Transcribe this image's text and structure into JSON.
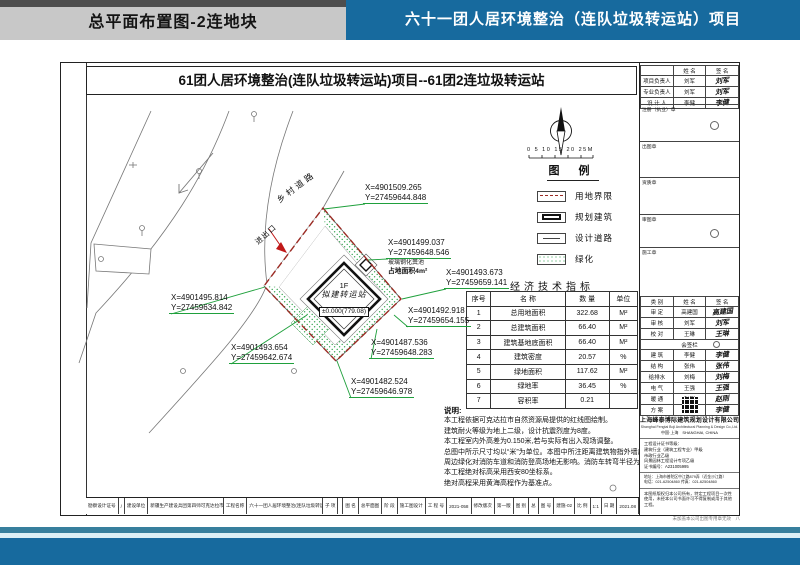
{
  "header": {
    "left_title": "总平面布置图-2连地块",
    "right_title": "六十一团人居环境整治（连队垃圾转运站）项目"
  },
  "colors": {
    "accent_blue": "#176a9e",
    "header_gray": "#c8c8c8",
    "strip_dark": "#4e4e4e",
    "leader_green": "#1fa03c",
    "greenery_green": "#2ca04a",
    "boundary_red": "#9b2b24",
    "teal_strip": "#377f9d",
    "pale_strip": "#ddf0f6"
  },
  "sheet": {
    "title": "61团人居环境整治(连队垃圾转运站)项目--61团2连垃圾转运站",
    "scale_label": "0  5  10  15  20  25M",
    "legend": {
      "title": "图 例",
      "items": [
        {
          "label": "用地界限",
          "swatch": "boundary"
        },
        {
          "label": "规划建筑",
          "swatch": "building"
        },
        {
          "label": "设计道路",
          "swatch": "road"
        },
        {
          "label": "绿化",
          "swatch": "green"
        }
      ]
    },
    "plan": {
      "road_label": "乡村道路",
      "entrance_label": "进出口",
      "building": {
        "floor": "1F",
        "name": "拟建转运站",
        "elevation": "±0.000(779.08)"
      },
      "septic": {
        "line1": "玻璃钢化粪池",
        "line2": "占地面积4m²"
      },
      "coord_labels": [
        {
          "x": 302,
          "y": 120,
          "l1": "X=4901509.265",
          "l2": "Y=27459644.848",
          "px": 263,
          "py": 146
        },
        {
          "x": 325,
          "y": 175,
          "l1": "X=4901499.037",
          "l2": "Y=27459648.546",
          "px": 307,
          "py": 197
        },
        {
          "x": 383,
          "y": 205,
          "l1": "X=4901493.673",
          "l2": "Y=27459659.141",
          "px": 341,
          "py": 236
        },
        {
          "x": 345,
          "y": 243,
          "l1": "X=4901492.918",
          "l2": "Y=27459654.155",
          "px": 333,
          "py": 252
        },
        {
          "x": 308,
          "y": 275,
          "l1": "X=4901487.536",
          "l2": "Y=27459648.283",
          "px": 316,
          "py": 266
        },
        {
          "x": 288,
          "y": 314,
          "l1": "X=4901482.524",
          "l2": "Y=27459646.978",
          "px": 276,
          "py": 298
        },
        {
          "x": 168,
          "y": 280,
          "l1": "X=4901493.654",
          "l2": "Y=27459642.674",
          "px": 246,
          "py": 252
        },
        {
          "x": 108,
          "y": 230,
          "l1": "X=4901495.814",
          "l2": "Y=27459634.842",
          "px": 204,
          "py": 224
        }
      ]
    },
    "table": {
      "title": "经济技术指标",
      "headers": [
        "序号",
        "名  称",
        "数  量",
        "单位"
      ],
      "rows": [
        [
          "1",
          "总用地面积",
          "322.68",
          "M²"
        ],
        [
          "2",
          "总建筑面积",
          "66.40",
          "M²"
        ],
        [
          "3",
          "建筑基地底面积",
          "66.40",
          "M²"
        ],
        [
          "4",
          "建筑密度",
          "20.57",
          "%"
        ],
        [
          "5",
          "绿地面积",
          "117.62",
          "M²"
        ],
        [
          "6",
          "绿地率",
          "36.45",
          "%"
        ],
        [
          "7",
          "容积率",
          "0.21",
          ""
        ]
      ]
    },
    "notes": {
      "title": "说明:",
      "lines": [
        "本工程依据可克达拉市自然资源局提供的红线图绘制。",
        "建筑耐火等级为地上二级，设计抗震烈度为8度。",
        "本工程室内外高差为0.150米,若与实际有出入现场调整。",
        "总图中所示尺寸均以“米”为单位。本图中所注距离建筑物指外墙皮。",
        "周边绿化对消防车道和消防登高场地无影响。消防车转弯半径为9米。",
        "本工程绝对标高采用西安80坐标系。",
        "绝对高程采用黄海高程作为基准点。"
      ]
    }
  },
  "titleblock": {
    "personnel_headers": [
      "",
      "姓 名",
      "签 名"
    ],
    "personnel": [
      [
        "项目负责人",
        "刘军",
        "刘军"
      ],
      [
        "专业负责人",
        "刘军",
        "刘军"
      ],
      [
        "设 计 人",
        "李健",
        "李健"
      ]
    ],
    "stamps": [
      {
        "label": "注册（执业）章",
        "seal": true
      },
      {
        "label": "出图章",
        "seal": false
      },
      {
        "label": "资质章",
        "seal": false
      },
      {
        "label": "审图章",
        "seal": true
      },
      {
        "label": "施工章",
        "seal": false
      }
    ],
    "sign_headers": [
      "类 别",
      "姓 名",
      "签 名"
    ],
    "cosign_label": "会签栏",
    "sign_rows_top": [
      [
        "审 定",
        "高建国",
        "高建国"
      ],
      [
        "审 核",
        "刘军",
        "刘军"
      ],
      [
        "校 对",
        "王琳",
        "王琳"
      ]
    ],
    "sign_rows_bottom": [
      [
        "建 筑",
        "李健",
        "李健"
      ],
      [
        "结 构",
        "张伟",
        "张伟"
      ],
      [
        "给排水",
        "刘梅",
        "刘梅"
      ],
      [
        "电 气",
        "王强",
        "王强"
      ],
      [
        "暖 通",
        "赵刚",
        "赵刚"
      ],
      [
        "方 案",
        "李健",
        "李健"
      ]
    ],
    "company": {
      "name": "上海峰泰博际建筑规划设计有限公司",
      "eng": "Shanghai Fengtai Boji Architectural Planning & Design Co.,Ltd.",
      "loc": "中国·上海　SHANGHAI, CHINA",
      "cert_lines": [
        "工程设计证书等级：",
        "建筑行业（建筑工程专业）甲级",
        "市政行业乙级",
        "风景园林工程设计专项乙级",
        "证书编号：A231005995"
      ],
      "contact_lines": [
        "地址：上海市普陀区中江路879弄（近金沙江路）",
        "电话：021-62504860  传真：021-62504860"
      ],
      "disclaimer": "本图纸版权归本公司所有，特定工程项目一次性使用，未经本公司书面许可不得复制或用于其他工程。"
    }
  },
  "bottombar": {
    "cells": [
      {
        "k": "勘察设计证号",
        "v": "/",
        "grow": false
      },
      {
        "k": "建设单位",
        "v": "新疆生产建设兵团第四师可克达拉市六十一团",
        "grow": true
      },
      {
        "k": "工程名称",
        "v": "六十一团人居环境整治(连队垃圾转运站)项目",
        "grow": true
      },
      {
        "k": "子 项",
        "v": "",
        "grow": false
      },
      {
        "k": "图 名",
        "v": "总平面图",
        "grow": false
      },
      {
        "k": "阶 段",
        "v": "施工图设计",
        "grow": false
      },
      {
        "k": "工 程 号",
        "v": "2021-058",
        "grow": false
      },
      {
        "k": "修改版次",
        "v": "第一版",
        "grow": false
      },
      {
        "k": "图 别",
        "v": "总",
        "grow": false
      },
      {
        "k": "图 号",
        "v": "建施-02",
        "grow": false
      },
      {
        "k": "比 例",
        "v": "1:1",
        "grow": false
      },
      {
        "k": "日 期",
        "v": "2021.08",
        "grow": false
      }
    ]
  },
  "below_note": "未加盖本公司出图专用章无效　八"
}
